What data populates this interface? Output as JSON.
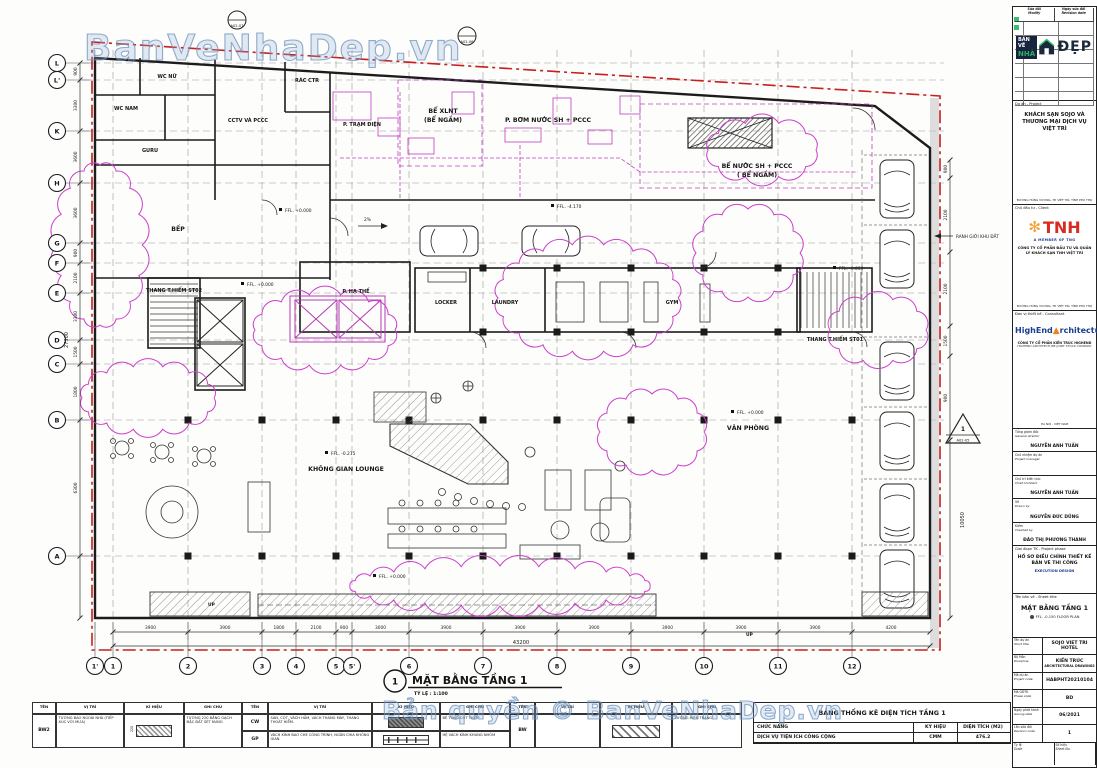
{
  "watermarks": {
    "top": "BanVeNhaDep.vn",
    "bottom": "Bản quyền © BanVeNhaDep.vn"
  },
  "figure": {
    "number": "1",
    "title": "MẶT BẰNG TẦNG 1",
    "scale": "TỶ LỆ : 1:100"
  },
  "plan": {
    "grid_cols": [
      "1'",
      "1",
      "2",
      "3",
      "4",
      "5",
      "5'",
      "6",
      "7",
      "8",
      "9",
      "10",
      "11",
      "12"
    ],
    "grid_rows": [
      "L",
      "L'",
      "K",
      "H",
      "G",
      "F",
      "E",
      "D",
      "C",
      "B",
      "A"
    ],
    "dims_bottom": [
      "3900",
      "3900",
      "1800",
      "2100",
      "900",
      "3000",
      "3900",
      "3900",
      "3900",
      "3900",
      "3900",
      "3900",
      "4200"
    ],
    "dim_bottom_total": "43200",
    "dims_left": [
      "900",
      "3300",
      "3600",
      "3600",
      "900",
      "2100",
      "3300",
      "1500",
      "1800",
      "6300"
    ],
    "dim_left_total": "27300",
    "dims_right": [
      "900",
      "2100",
      "2100",
      "1500",
      "900"
    ],
    "dim_right_total": "10050",
    "rooms": {
      "wc_nu": "WC NỮ",
      "wc_nam": "WC NAM",
      "cctv": "CCTV VÀ PCCC",
      "rac": "RÁC CTR",
      "guru": "GURU",
      "bep": "BẾP",
      "tram": "P. TRẠM ĐIỆN",
      "be_xlnt_1": "BỂ XLNT",
      "be_xlnt_2": "(BỂ NGẦM)",
      "bom": "P. BƠM NƯỚC SH + PCCC",
      "be_nuoc_1": "BỂ NƯỚC SH + PCCC",
      "be_nuoc_2": "( BỂ NGẦM)",
      "thang2": "THANG T.HIỂM ST02",
      "ha_the": "P. HẠ THẾ",
      "locker": "LOCKER",
      "laundry": "LAUNDRY",
      "gym": "GYM",
      "thang1": "THANG T.HIỂM ST01",
      "van_phong": "VĂN PHÒNG",
      "lounge": "KHÔNG GIAN LOUNGE"
    },
    "levels": {
      "l1": "FFL. +0.000",
      "l2": "FFL. +0.000",
      "l3": "FFL. -4.170",
      "l4": "FFL. +0.000",
      "l5": "FFL. -0.215",
      "l6": "FFL. -0.050",
      "l7": "FFL. +0.000"
    },
    "notes": {
      "slope": "2%",
      "up_left": "UP",
      "up_right": "UP",
      "boundary": "RANH GIỚI KHU ĐẤT"
    },
    "markers": {
      "m1": "A02-07",
      "m2": "A02-06",
      "m3_num": "1",
      "m3": "A02-05"
    }
  },
  "titleblock": {
    "logo": {
      "line1": "BẢN VẼ",
      "line2": "NHÀ",
      "word": "ĐẸP"
    },
    "revision_header": {
      "c1": "Sửa đổi",
      "c1en": "Modify",
      "c2": "Ngày sửa đổi",
      "c2en": "Revision date"
    },
    "project": {
      "label": "Dự án  -  Project",
      "name": "KHÁCH SẠN SOJO VÀ THƯƠNG MẠI DỊCH VỤ VIỆT TRÌ",
      "address": "ĐƯỜNG HÙNG VƯƠNG, TP. VIỆT TRÌ, TỈNH PHÚ THỌ"
    },
    "client": {
      "label": "Chủ đầu tư  -  Client",
      "logo": "TNH",
      "flower": "✻",
      "member": "A MEMBER OF TNG",
      "name": "CÔNG TY CỔ PHẦN ĐẦU TƯ VÀ QUẢN LÝ KHÁCH SẠN TNH VIỆT TRÌ",
      "address": "ĐƯỜNG HÙNG VƯƠNG, TP. VIỆT TRÌ, TỈNH PHÚ THỌ"
    },
    "consultant": {
      "label": "Đơn vị thiết kế  -  Consultant",
      "logo_a": "HighEnd",
      "logo_tri": "▲",
      "logo_b": "rchitecture",
      "name": "CÔNG TY CỔ PHẦN KIẾN TRÚC HIGHEND",
      "name_en": "HIGHEND ARCHITECTURE JOINT STOCK COMPANY",
      "address": "HÀ NỘI - VIỆT NAM"
    },
    "people": [
      {
        "role": "Tổng giám đốc",
        "role_en": "General director",
        "name": "NGUYỄN ANH TUẤN"
      },
      {
        "role": "Chủ nhiệm dự án",
        "role_en": "Project manager",
        "name": ""
      },
      {
        "role": "Chủ trì kiến trúc",
        "role_en": "Chief Architect",
        "name": "NGUYỄN ANH TUẤN"
      },
      {
        "role": "Vẽ",
        "role_en": "Drawn by",
        "name": "NGUYỄN ĐỨC DŨNG"
      },
      {
        "role": "Kiểm",
        "role_en": "Checked by",
        "name": "ĐÀO THỊ PHƯƠNG THANH"
      }
    ],
    "phase": {
      "label": "Giai đoạn TK  -  Project phase",
      "name": "HỒ SƠ ĐIỀU CHỈNH THIẾT KẾ BẢN VẼ THI CÔNG",
      "name_en": "EXECUTION DESIGN"
    },
    "sheet": {
      "label": "Tên bản vẽ - Sheet title",
      "name": "MẶT BẰNG TẦNG 1",
      "sub": "FFL. -0.150 FLOOR PLAN"
    },
    "info": [
      {
        "label": "Tên dự án",
        "label_en": "Short title",
        "value": "SOJO VIET TRI HOTEL",
        "value2": ""
      },
      {
        "label": "Bộ Môn",
        "label_en": "Discipline",
        "value": "KIẾN TRÚC",
        "value2": "ARCHITECTURAL DRAWINGS"
      },
      {
        "label": "Mã dự án",
        "label_en": "Project code",
        "value": "HABPHT20210104",
        "value2": ""
      },
      {
        "label": "Mã GĐTK",
        "label_en": "Phase code",
        "value": "BD",
        "value2": ""
      },
      {
        "label": "Ngày phát hành",
        "label_en": "Issuing date",
        "value": "06/2021",
        "value2": ""
      },
      {
        "label": "Lần sửa đổi",
        "label_en": "Revision code",
        "value": "1",
        "value2": ""
      }
    ],
    "scale_row": {
      "label": "Tỷ lệ",
      "label_en": "Scale",
      "label2": "Số hiệu",
      "label2_en": "Sheet No."
    }
  },
  "legend": {
    "headers": {
      "ten": "TÊN",
      "vitri": "VỊ TRÍ",
      "kyhieu": "KÍ HIỆU",
      "ghichu": "GHI CHÚ"
    },
    "groups": [
      {
        "rows": [
          {
            "ten": "BW2",
            "vitri": "TƯỜNG BAO NGOÀI NHÀ (TIẾP XÚC VỚI MƯA)",
            "sym": "brick",
            "dim": "220",
            "ghichu": "TƯỜNG 220 BẰNG GẠCH ĐẶC ĐẤT SÉT NUNG"
          }
        ]
      },
      {
        "rows": [
          {
            "ten": "CW",
            "vitri": "SÀN, CỘT, VÁCH HẦM, VÁCH THANG MÁY, THANG THOÁT HIỂM.",
            "sym": "concrete",
            "dim": "",
            "ghichu": "BÊ TÔNG CỐT THÉP"
          },
          {
            "ten": "GP",
            "vitri": "VÁCH KÍNH BAO CHE CÔNG TRÌNH, NGĂN CHIA KHÔNG GIAN",
            "sym": "glass",
            "dim": "",
            "ghichu": "HỆ VÁCH KÍNH KHUNG NHÔM"
          }
        ]
      },
      {
        "rows": [
          {
            "ten": "BW",
            "vitri": "",
            "sym": "diag",
            "dim": "",
            "ghichu": "TƯỜNG HIỆN TRẠNG"
          }
        ]
      }
    ]
  },
  "area_table": {
    "title": "BẢNG THỐNG KÊ DIỆN TÍCH TẦNG 1",
    "headers": [
      "CHỨC NĂNG",
      "KÝ HIỆU",
      "DIỆN TÍCH (M2)"
    ],
    "rows": [
      [
        "DỊCH VỤ TIỆN ÍCH CÔNG CỘNG",
        "CMM",
        "476.2"
      ]
    ]
  }
}
